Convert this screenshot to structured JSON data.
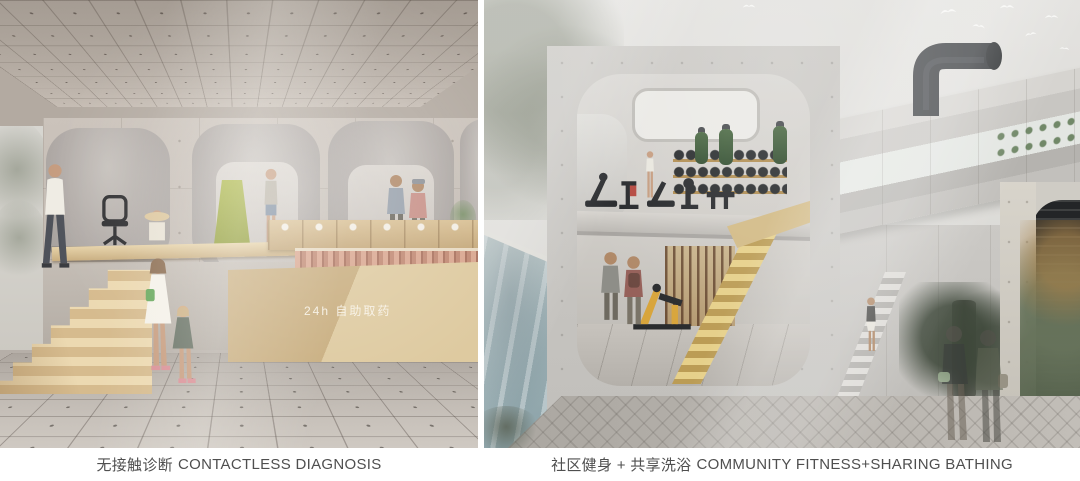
{
  "captions": {
    "left": {
      "zh": "无接触诊断",
      "en": "CONTACTLESS DIAGNOSIS"
    },
    "right": {
      "zh": "社区健身 + 共享洗浴",
      "en": "COMMUNITY FITNESS+SHARING BATHING"
    }
  },
  "left_panel": {
    "sign_text": "24h 自助取药"
  },
  "palette": {
    "caption_text": "#4f4f4f",
    "wood": "#d9c298",
    "concrete_warm": "#c6bdb4",
    "concrete_cool": "#c8c6c2",
    "pool_water": "#a3b4ba",
    "green_chair": "#9fae3c",
    "stair_yellow": "#d8c277",
    "punching_bag_green": "#3e5f3e",
    "pipe_black": "#3a3e41",
    "medicine_slat_pink": "#c08872",
    "sign_text_color": "#f5efe6"
  },
  "icons": {
    "bird": "white swallow silhouette (svg shape)",
    "office-chair": "black task chair silhouette (svg shape)",
    "person": "human figure silhouette (svg shape)"
  }
}
